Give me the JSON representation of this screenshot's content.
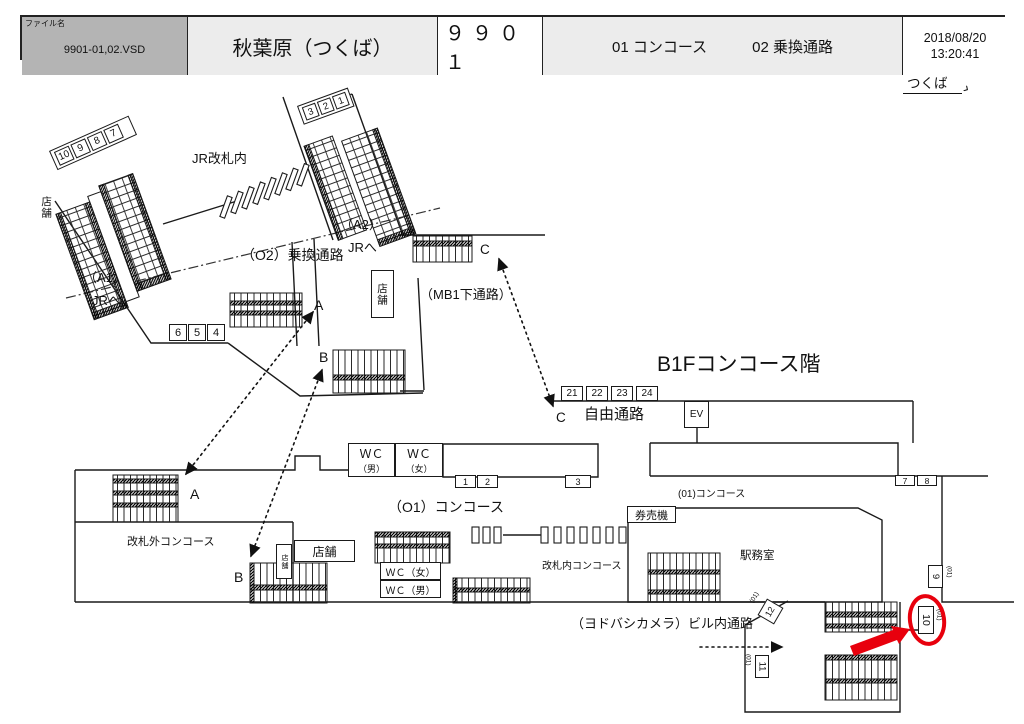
{
  "header": {
    "file_label": "ファイル名",
    "file_name": "9901-01,02.VSD",
    "station": "秋葉原（つくば）",
    "code": "９９０１",
    "sheet1": "01 コンコース",
    "sheet2": "02 乗換通路",
    "date": "2018/08/20",
    "time": "13:20:41"
  },
  "direction": {
    "label": "つくば",
    "arrow": "›"
  },
  "floor_title": "B1Fコンコース階",
  "areas": {
    "jr_inside": "JR改札内",
    "a1": "（A1）",
    "a1_dest": "JRへ",
    "a2": "（A2）",
    "a2_dest": "JRへ",
    "o2": "（O2）乗換通路",
    "mb1": "（MB1下通路）",
    "free_passage": "自由通路",
    "o1": "（O1）コンコース",
    "outside_gate": "改札外コンコース",
    "inside_gate": "改札内コンコース",
    "ticket_machines": "券売機",
    "station_office": "駅務室",
    "o1_small": "(01)コンコース",
    "yodobashi": "（ヨドバシカメラ）ビル内通路",
    "ev": "EV"
  },
  "shops": {
    "s1": "店舗",
    "s2": "店舗",
    "s3": "店舗",
    "s4": "店舗"
  },
  "wc": {
    "upper_m_top": "ＷＣ",
    "upper_m_sub": "（男）",
    "upper_f_top": "ＷＣ",
    "upper_f_sub": "（女）",
    "lower_f": "ＷＣ（女）",
    "lower_m": "ＷＣ（男）"
  },
  "points": {
    "a": "A",
    "b": "B",
    "c": "C"
  },
  "ad_boxes": {
    "row_a1": [
      "10",
      "9",
      "8",
      "7"
    ],
    "row_a2": [
      "3",
      "2",
      "1"
    ],
    "row_654": [
      "6",
      "5",
      "4"
    ],
    "row_2124": [
      "21",
      "22",
      "23",
      "24"
    ],
    "row_12": [
      "1",
      "2"
    ],
    "box_3": "3",
    "row_78": [
      "7",
      "8"
    ],
    "box_9": "9",
    "box_10": "10",
    "box_11": "11",
    "box_12": "12",
    "loc_tag": "(01)"
  },
  "colors": {
    "red": "#e8000d",
    "line": "#1a1a1a",
    "header_gray": "#b4b4b4",
    "header_light": "#ececec"
  }
}
